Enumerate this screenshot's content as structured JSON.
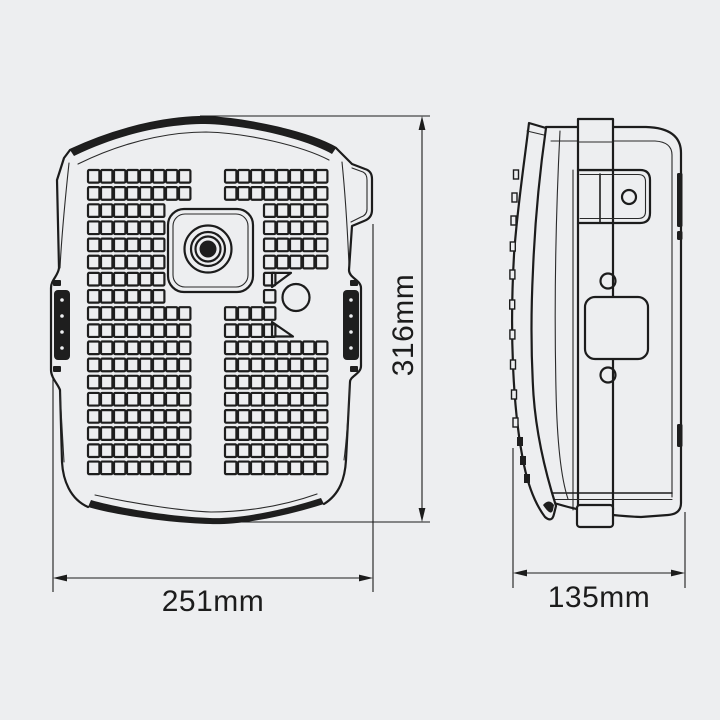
{
  "drawing": {
    "front_view": {
      "width_label": "251mm",
      "height_label": "316mm"
    },
    "side_view": {
      "depth_label": "135mm"
    },
    "colors": {
      "background": "#edeef0",
      "line": "#1c1c1c",
      "dark_fill": "#1e1e1e"
    }
  }
}
